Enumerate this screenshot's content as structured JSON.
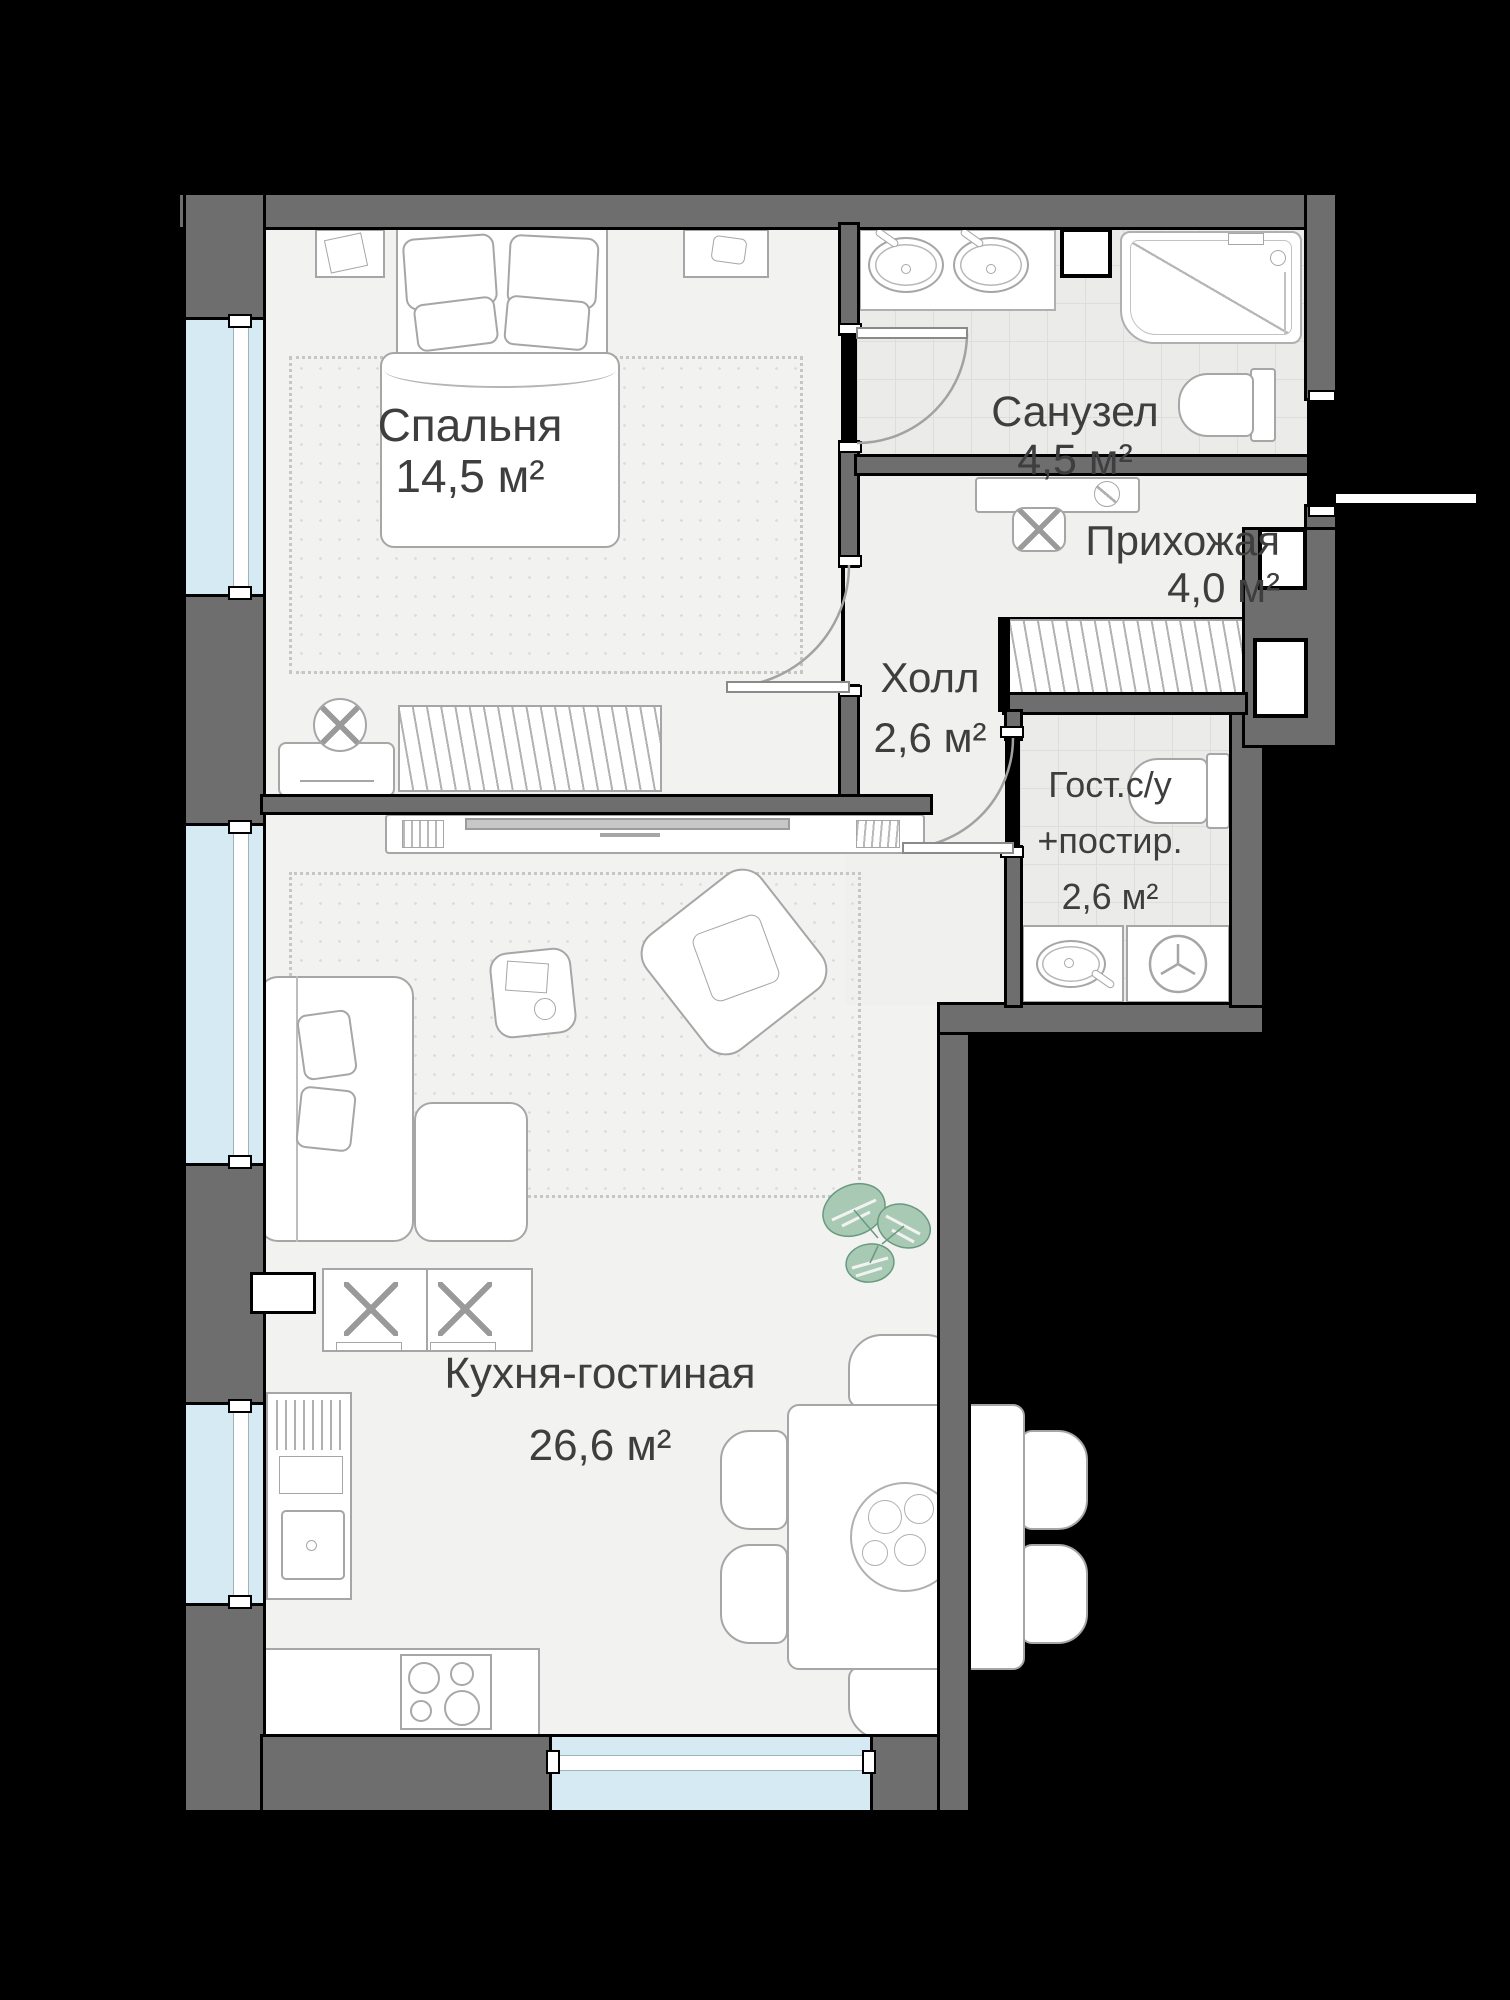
{
  "title": "Floor plan — 1-bedroom apartment",
  "rooms": [
    {
      "id": "bedroom",
      "name": "Спальня",
      "area": "14,5 м²"
    },
    {
      "id": "bathroom",
      "name": "Санузел",
      "area": "4,5 м²"
    },
    {
      "id": "entry-hall",
      "name": "Прихожая",
      "area": "4,0 м²"
    },
    {
      "id": "hall",
      "name": "Холл",
      "area": "2,6 м²"
    },
    {
      "id": "guest-wc",
      "name": "Гост.с/у",
      "name2": "+постир.",
      "area": "2,6 м²"
    },
    {
      "id": "kitchen-living",
      "name": "Кухня-гостиная",
      "area": "26,6 м²"
    }
  ],
  "colors": {
    "background": "#000000",
    "wall": "#6e6e6e",
    "floor": "#f2f2f0",
    "tile": "#ebebe9",
    "window": "#d6eaf4",
    "furniture_line": "#a6a6a6",
    "text": "#3e3e3e",
    "plant": "#a8cab5"
  },
  "icons": [
    "double-bed-icon",
    "pillow-icon",
    "nightstand-icon",
    "wardrobe-hatch-icon",
    "dresser-icon",
    "fan-icon",
    "tv-console-icon",
    "tv-icon",
    "sofa-icon",
    "armchair-icon",
    "side-table-icon",
    "monstera-plant-icon",
    "dining-table-icon",
    "chair-icon",
    "plate-icon",
    "hob-icon",
    "kitchen-sink-icon",
    "tall-cabinet-icon",
    "upper-cabinet-icon",
    "vanity-double-sink-icon",
    "bathtub-shower-icon",
    "toilet-icon",
    "washbasin-icon",
    "washing-machine-icon",
    "stool-icon",
    "console-icon",
    "door-swing-icon",
    "duct-shaft-icon"
  ]
}
